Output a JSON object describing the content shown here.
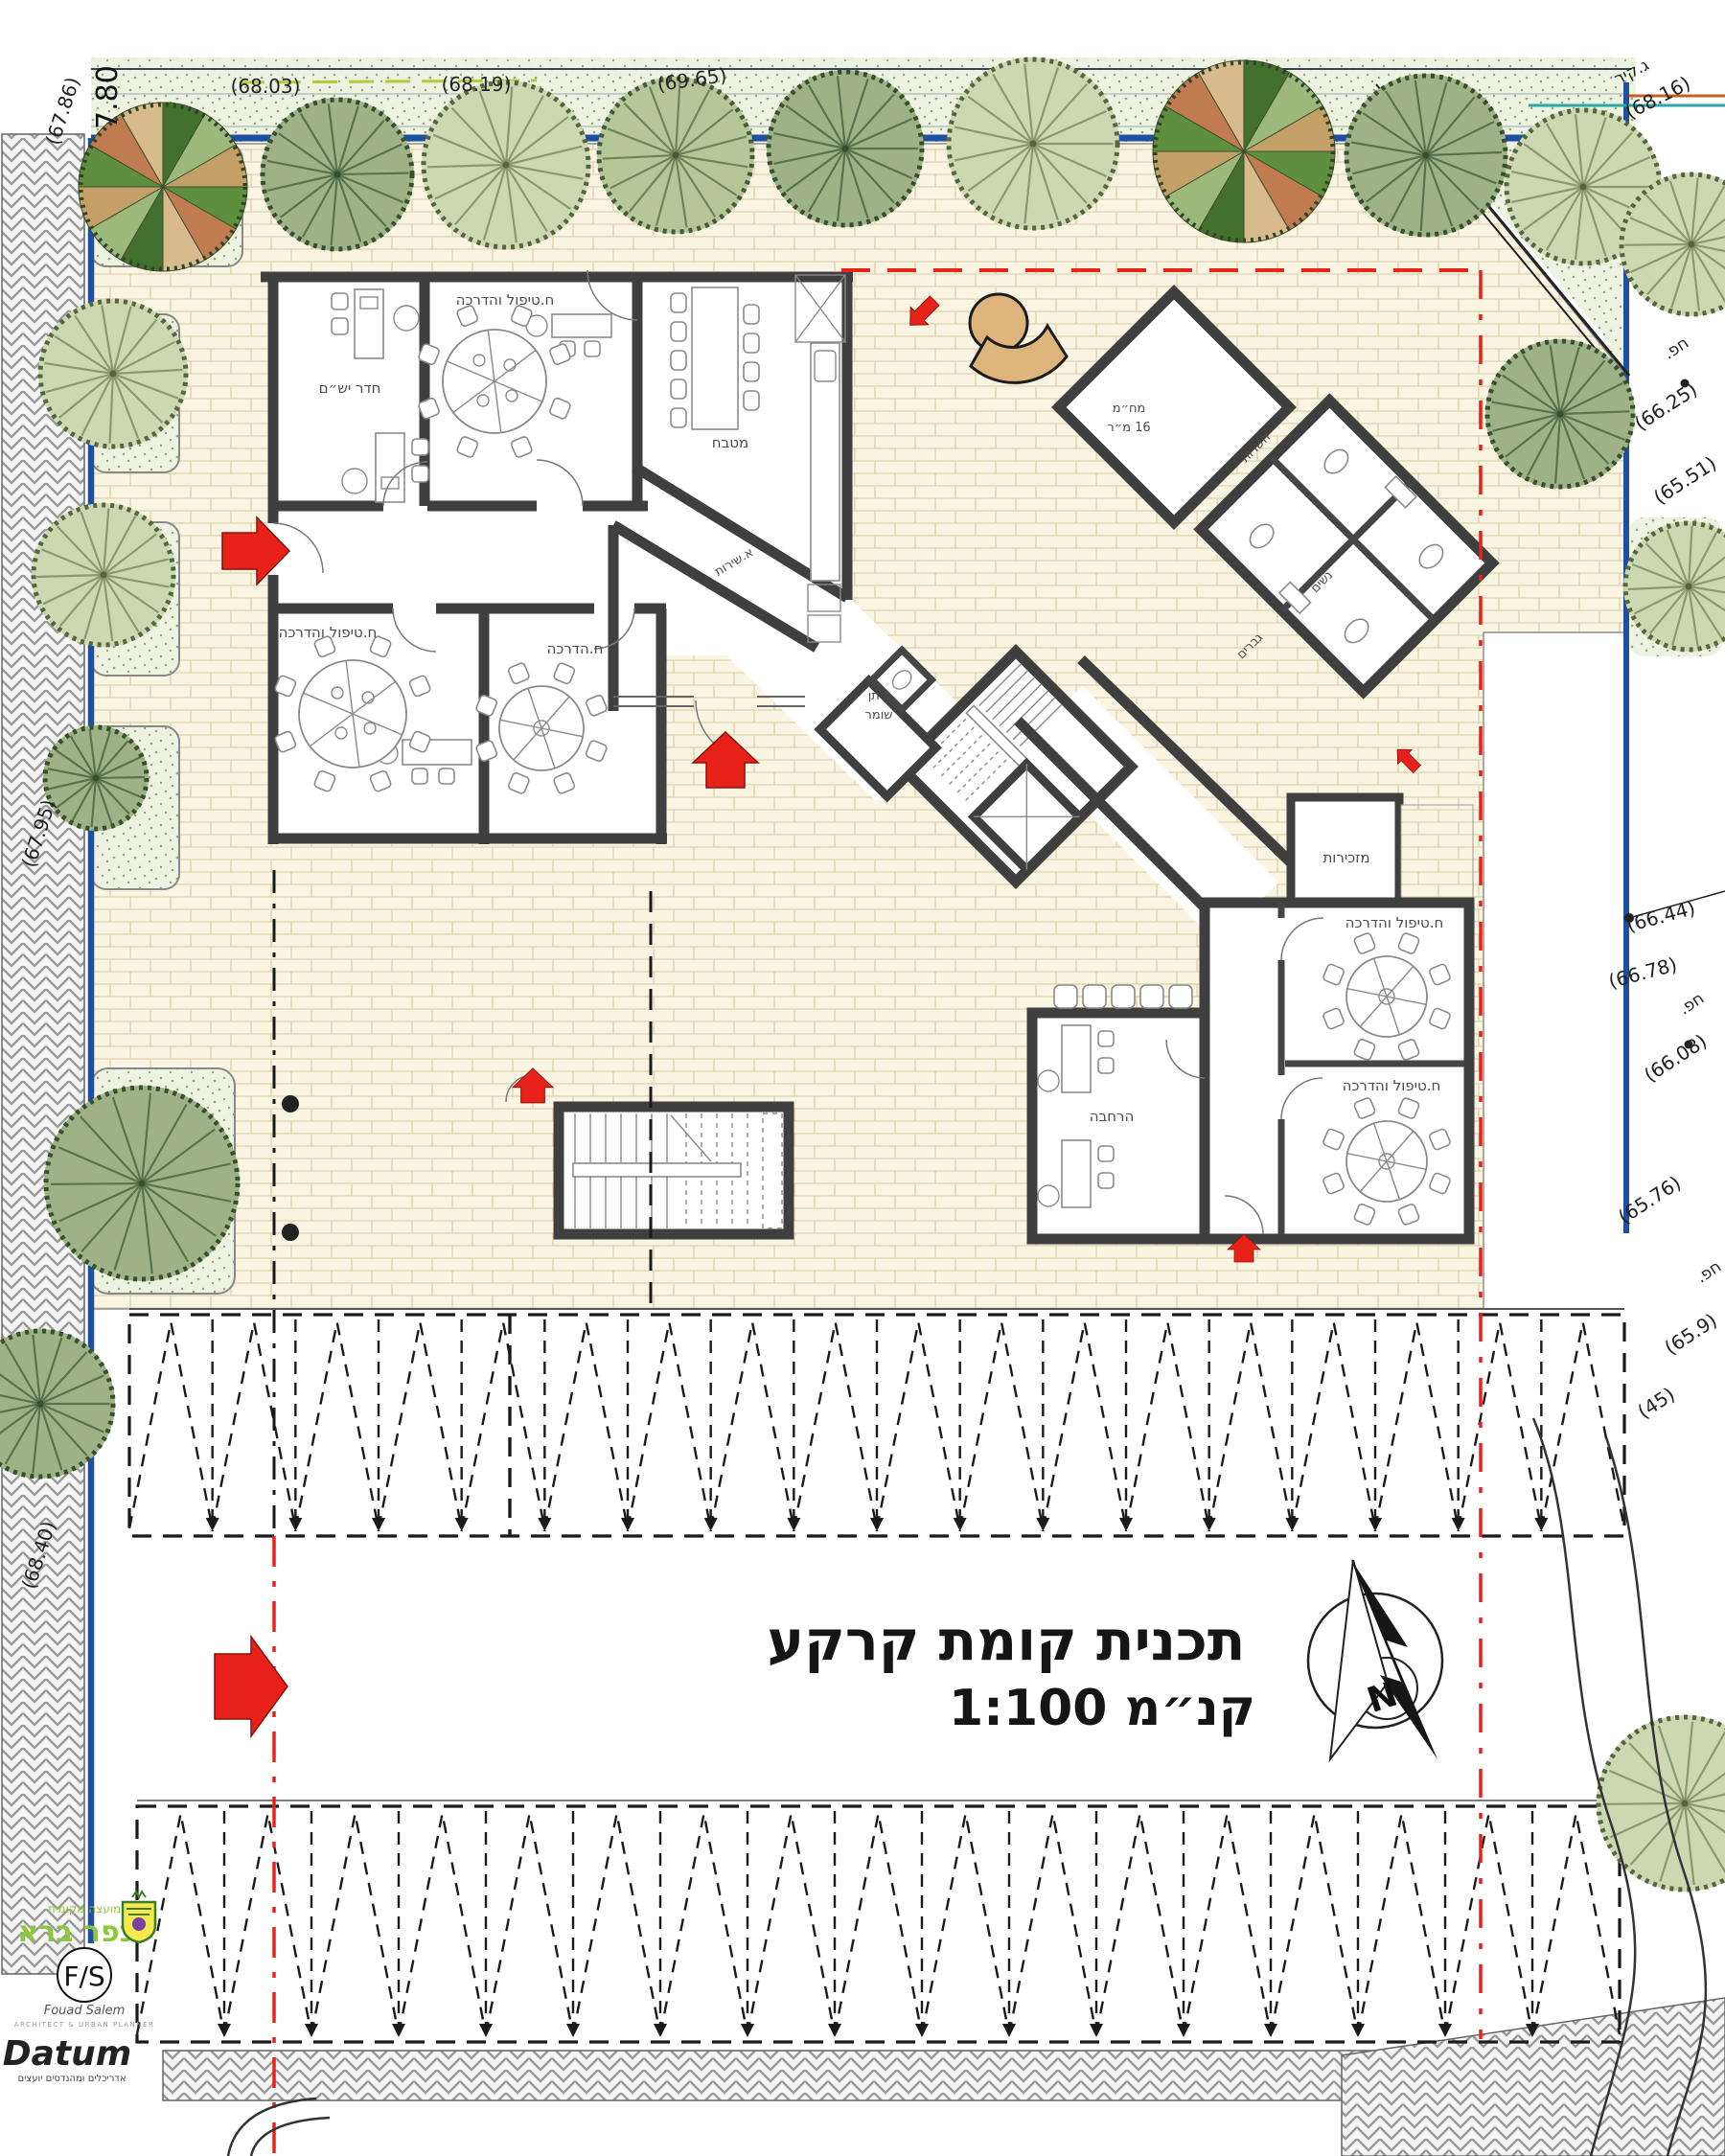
{
  "title": {
    "line1": "תכנית קומת קרקע",
    "line2": "קנ״מ 1:100"
  },
  "compass": {
    "north_letter": "N"
  },
  "rooms": {
    "meeting": "חדר יש״ם",
    "treatment": "ח.טיפול והדרכה",
    "guidance": "ח.הדרכה",
    "kitchen": "מטבח",
    "service_corridor": "א.שירות",
    "shelter_line1": "מח״מ",
    "shelter_line2": "16 מ״ר",
    "services": "השרות",
    "women": "נשים",
    "men": "גברים",
    "guard_line1": "ביתן",
    "guard_line2": "שומר",
    "secretariat": "מזכירות",
    "expansion": "הרחבה"
  },
  "elevations": {
    "top1": "(68.03)",
    "top2": "(68.19)",
    "top3": "(69.65)",
    "wall_label": "ג.קיר",
    "wall_elev": "(68.16)",
    "yard1": "חפ.",
    "r1a": "(66.25)",
    "r1b": "(65.51)",
    "r2": "(66.44)",
    "r3": "(66.78)",
    "yard2": "חפ.",
    "r4": "(66.08)",
    "r5": "(65.76)",
    "yard3": "חפ.",
    "r6": "(65.9)",
    "r7": "(45)",
    "left1": "(67.86)",
    "left_dim": "7.80",
    "left2": "(67.95)",
    "left3": "(68.40)"
  },
  "logos": {
    "council_line1": "מועצה מקומית",
    "council_line2": "כפר ברא",
    "fs_initials": "F/S",
    "fs_signature": "Fouad Salem",
    "fs_subtitle": "ARCHITECT & URBAN PLANNER",
    "datum_name": "Datum",
    "datum_subtitle": "אדריכלים ומהנדסים יועצים"
  }
}
